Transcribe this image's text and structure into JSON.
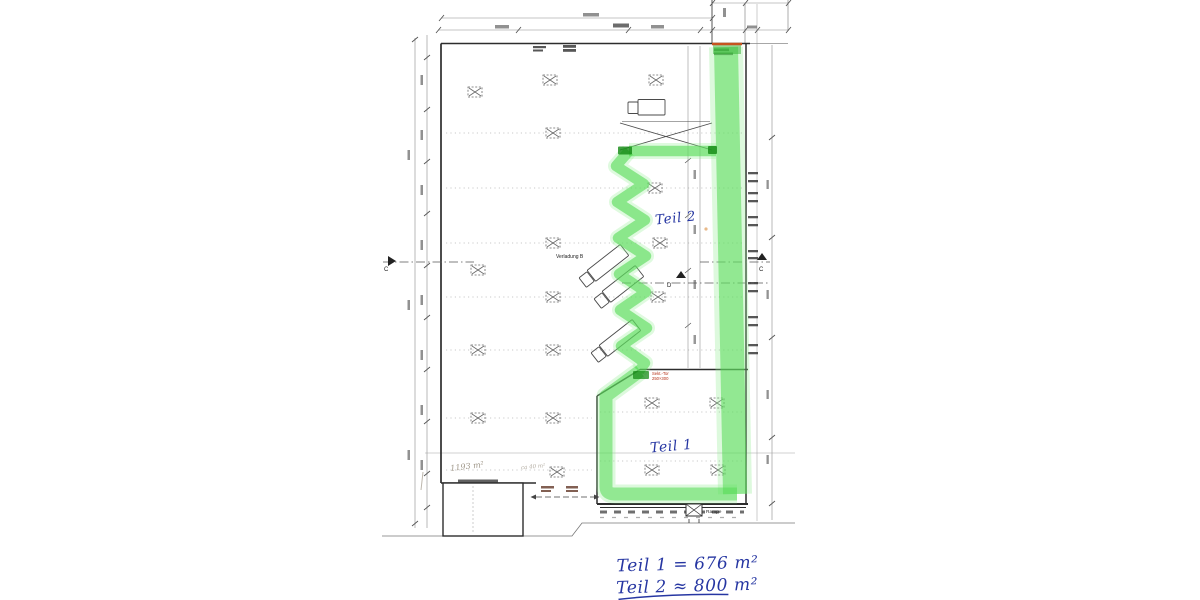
{
  "plan": {
    "region_label_teil2": "Teil 2",
    "region_label_teil1": "Teil 1",
    "verladung_label": "Verladung B",
    "rampe_label": "Rampe",
    "section_marker_left": "C",
    "section_marker_right": "C",
    "section_marker_d": "D",
    "red_door_line1": "Sekt.-Tor",
    "red_door_line2": "250×300",
    "pencil_note_main": "1193 m²",
    "pencil_note_small": "ca 40 m²"
  },
  "handwritten_summary": {
    "line1": "Teil 1 = 676 m²",
    "line2": "Teil 2 ≈ 800 m²"
  },
  "colors": {
    "highlight_green": "#54da54",
    "highlight_green_light": "#8dec8d",
    "highlight_green_dark": "#118811",
    "ink_blue": "#2636a2",
    "red_orange": "#c6541f",
    "red_ink": "#b53016",
    "pencil_gray": "#8f8575",
    "line_dark": "#2d2d2d"
  }
}
